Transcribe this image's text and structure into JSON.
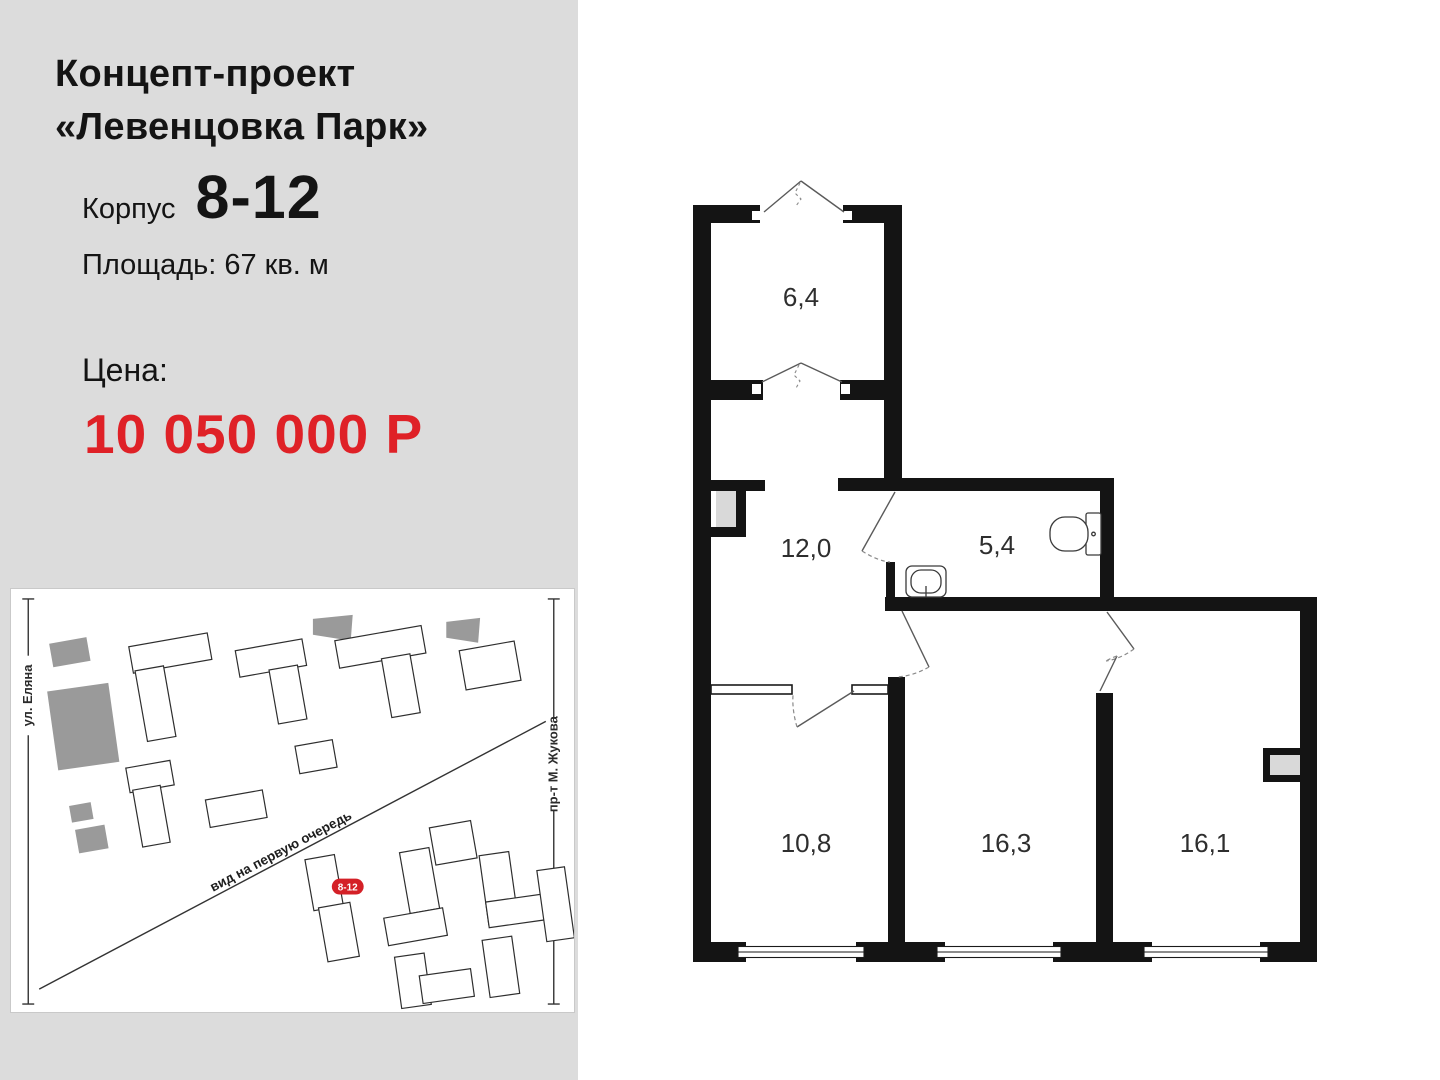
{
  "panel": {
    "title_line1": "Концепт-проект",
    "title_line2": "«Левенцовка Парк»",
    "korpus_label": "Корпус",
    "korpus_value": "8-12",
    "area_text": "Площадь: 67 кв. м",
    "price_label": "Цена:",
    "price_value": "10 050 000 Р",
    "panel_bg_color": "#dcdcdc",
    "price_color": "#df2127"
  },
  "map": {
    "street_left": "ул. Еляна",
    "street_right": "пр-т М. Жукова",
    "road_label": "вид на первую очередь",
    "badge": "8-12",
    "badge_color": "#d42027"
  },
  "plan": {
    "wall_color": "#141414",
    "rooms": [
      {
        "id": "loggia",
        "area": "6,4"
      },
      {
        "id": "hall",
        "area": "12,0"
      },
      {
        "id": "bathroom",
        "area": "5,4"
      },
      {
        "id": "bedroom-1",
        "area": "10,8"
      },
      {
        "id": "living-room",
        "area": "16,3"
      },
      {
        "id": "bedroom-2",
        "area": "16,1"
      }
    ]
  }
}
